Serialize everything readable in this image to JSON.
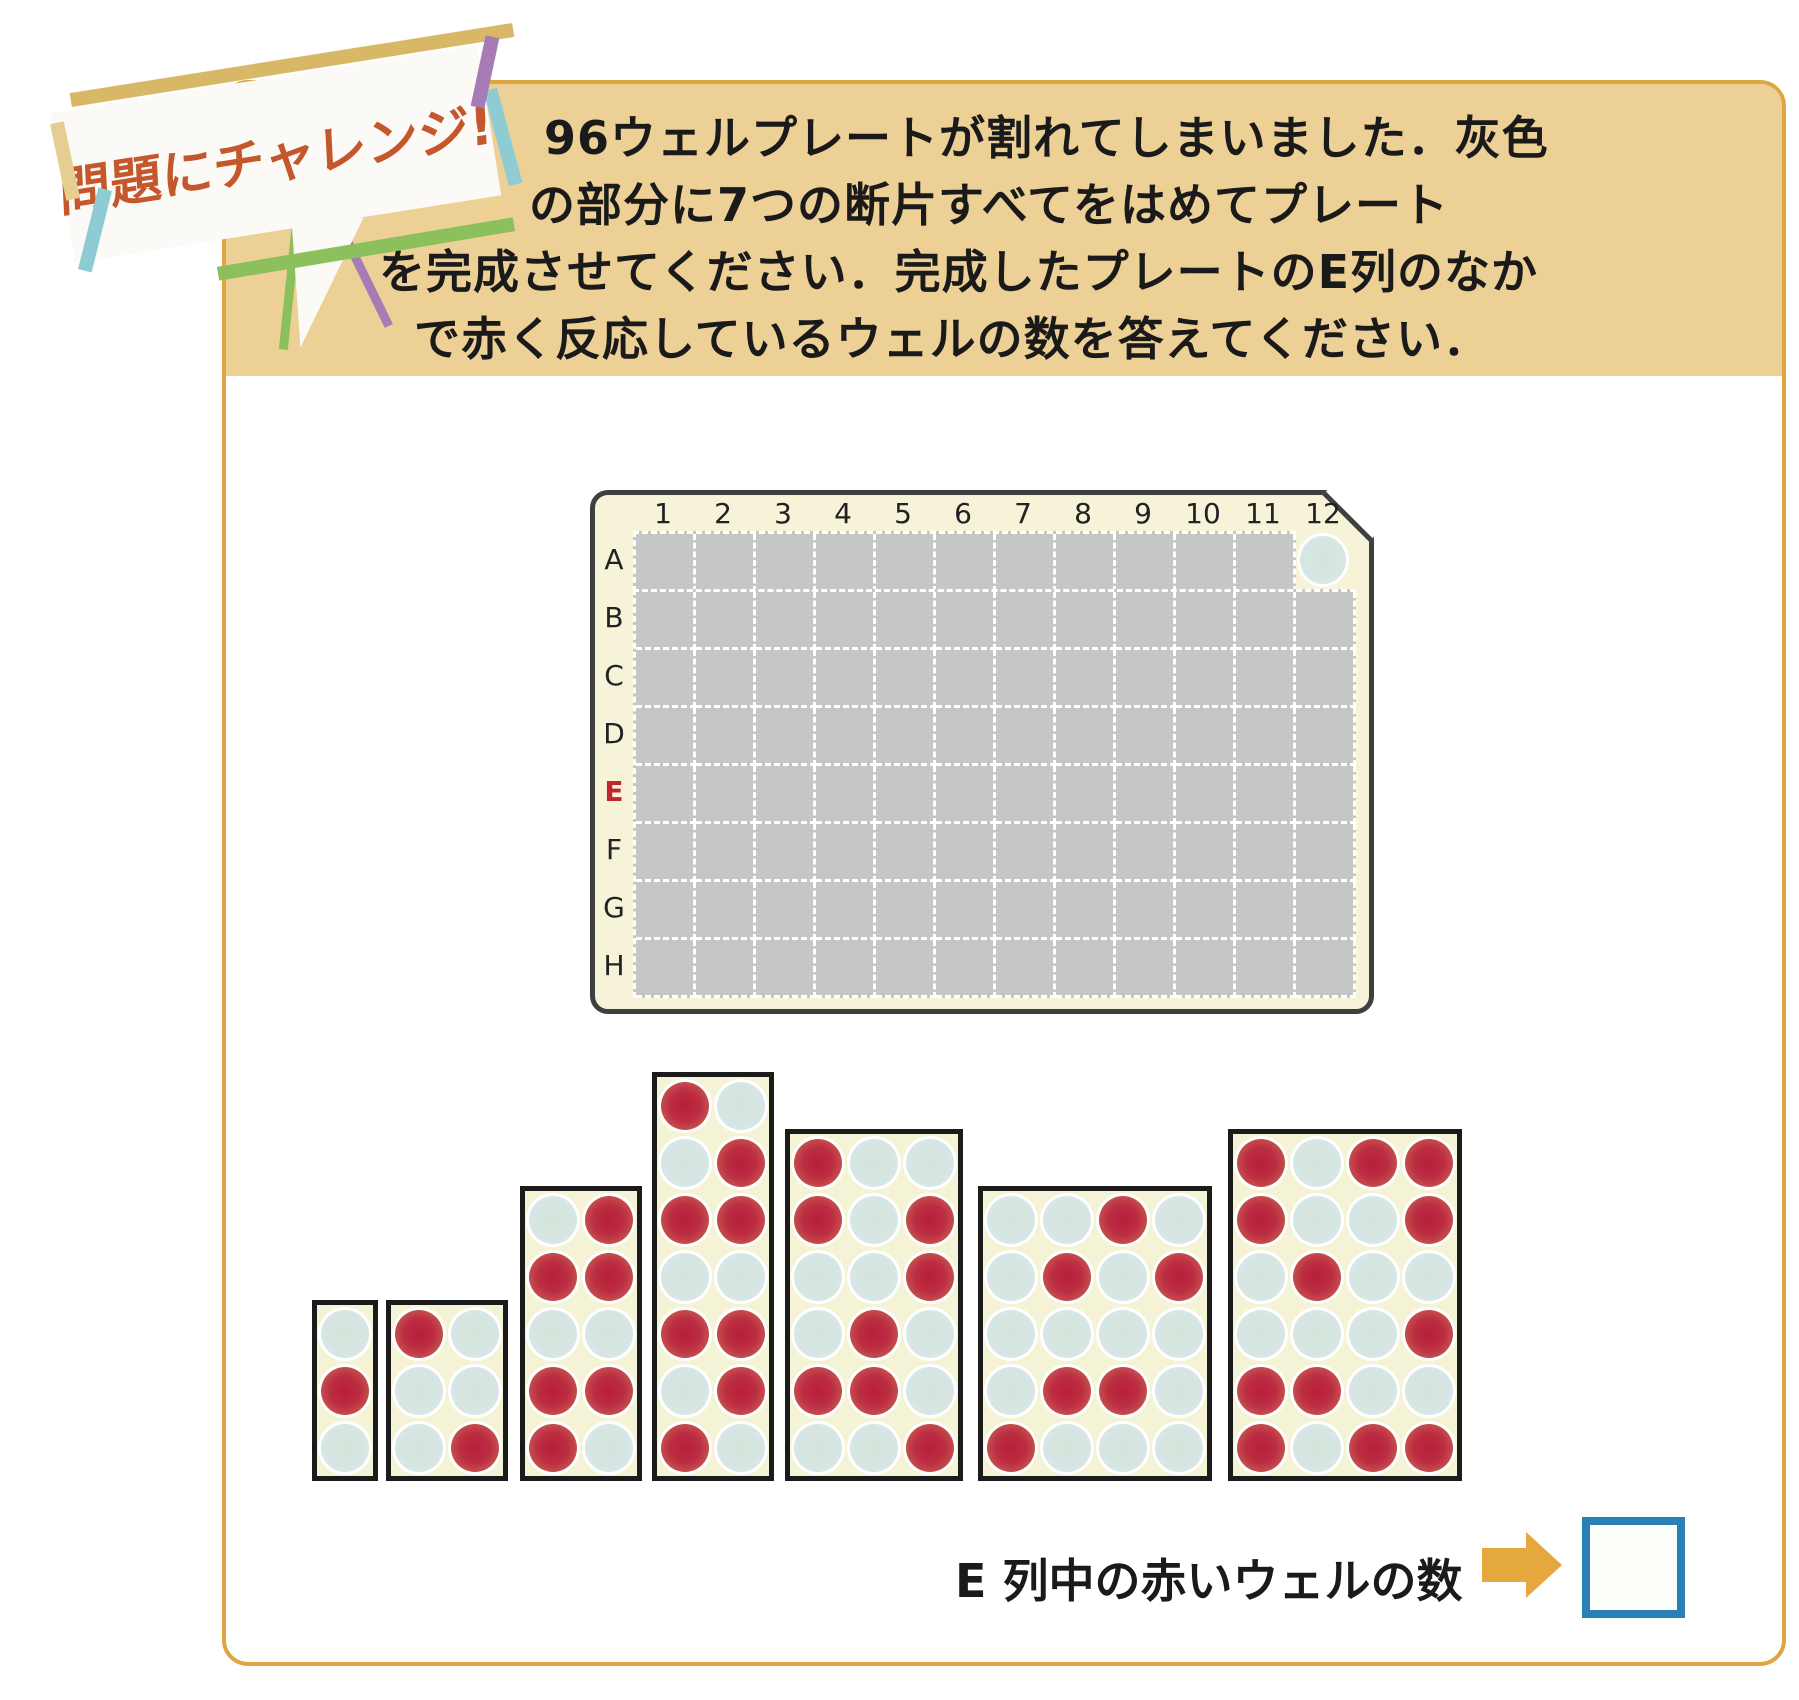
{
  "badge": {
    "label": "問題にチャレンジ!"
  },
  "instruction": {
    "lines": [
      "96ウェルプレートが割れてしまいました．灰色",
      "の部分に7つの断片すべてをはめてプレート",
      "を完成させてください．完成したプレートのE列のなか",
      "で赤く反応しているウェルの数を答えてください．"
    ]
  },
  "plate": {
    "column_labels": [
      "1",
      "2",
      "3",
      "4",
      "5",
      "6",
      "7",
      "8",
      "9",
      "10",
      "11",
      "12"
    ],
    "row_labels": [
      "A",
      "B",
      "C",
      "D",
      "E",
      "F",
      "G",
      "H"
    ],
    "highlighted_row": "E",
    "visible_well": {
      "row": "A",
      "column": "12",
      "state": "blue"
    },
    "broken_region": {
      "row_A_columns": "1-11",
      "rows_B_to_H_columns": "1-12",
      "total_gray_cells": 95
    }
  },
  "fragments": [
    {
      "id": 1,
      "cols": 1,
      "rows": 3,
      "pattern": [
        [
          "B"
        ],
        [
          "R"
        ],
        [
          "B"
        ]
      ]
    },
    {
      "id": 2,
      "cols": 2,
      "rows": 3,
      "pattern": [
        [
          "R",
          "B"
        ],
        [
          "B",
          "B"
        ],
        [
          "B",
          "R"
        ]
      ]
    },
    {
      "id": 3,
      "cols": 2,
      "rows": 5,
      "pattern": [
        [
          "B",
          "R"
        ],
        [
          "R",
          "R"
        ],
        [
          "B",
          "B"
        ],
        [
          "R",
          "R"
        ],
        [
          "R",
          "B"
        ]
      ]
    },
    {
      "id": 4,
      "cols": 2,
      "rows": 7,
      "pattern": [
        [
          "R",
          "B"
        ],
        [
          "B",
          "R"
        ],
        [
          "R",
          "R"
        ],
        [
          "B",
          "B"
        ],
        [
          "R",
          "R"
        ],
        [
          "B",
          "R"
        ],
        [
          "R",
          "B"
        ]
      ]
    },
    {
      "id": 5,
      "cols": 3,
      "rows": 6,
      "pattern": [
        [
          "R",
          "B",
          "B"
        ],
        [
          "R",
          "B",
          "R"
        ],
        [
          "B",
          "B",
          "R"
        ],
        [
          "B",
          "R",
          "B"
        ],
        [
          "R",
          "R",
          "B"
        ],
        [
          "B",
          "B",
          "R"
        ]
      ]
    },
    {
      "id": 6,
      "cols": 4,
      "rows": 5,
      "pattern": [
        [
          "B",
          "B",
          "R",
          "B"
        ],
        [
          "B",
          "R",
          "B",
          "R"
        ],
        [
          "B",
          "B",
          "B",
          "B"
        ],
        [
          "B",
          "R",
          "R",
          "B"
        ],
        [
          "R",
          "B",
          "B",
          "B"
        ]
      ]
    },
    {
      "id": 7,
      "cols": 4,
      "rows": 6,
      "pattern": [
        [
          "R",
          "B",
          "R",
          "R"
        ],
        [
          "R",
          "B",
          "B",
          "R"
        ],
        [
          "B",
          "R",
          "B",
          "B"
        ],
        [
          "B",
          "B",
          "B",
          "R"
        ],
        [
          "R",
          "R",
          "B",
          "B"
        ],
        [
          "R",
          "B",
          "R",
          "R"
        ]
      ]
    }
  ],
  "answer": {
    "label": "E 列中の赤いウェルの数",
    "value": ""
  },
  "colors": {
    "panel_border_gold": "#dfa63f",
    "header_tan": "#ecd096",
    "badge_text_orange": "#c4582c",
    "tape_gold": "#d8b867",
    "tape_green": "#8cc05c",
    "tape_teal": "#8ecbd2",
    "tape_purple": "#a77bb5",
    "plate_cream": "#f6f3d9",
    "broken_gray": "#c6c6c6",
    "well_red": "#b81e3b",
    "well_blue": "#d9e8ee",
    "row_e_red": "#c0272d",
    "arrow_gold": "#e5a83e",
    "answer_box_blue": "#2980b9"
  }
}
